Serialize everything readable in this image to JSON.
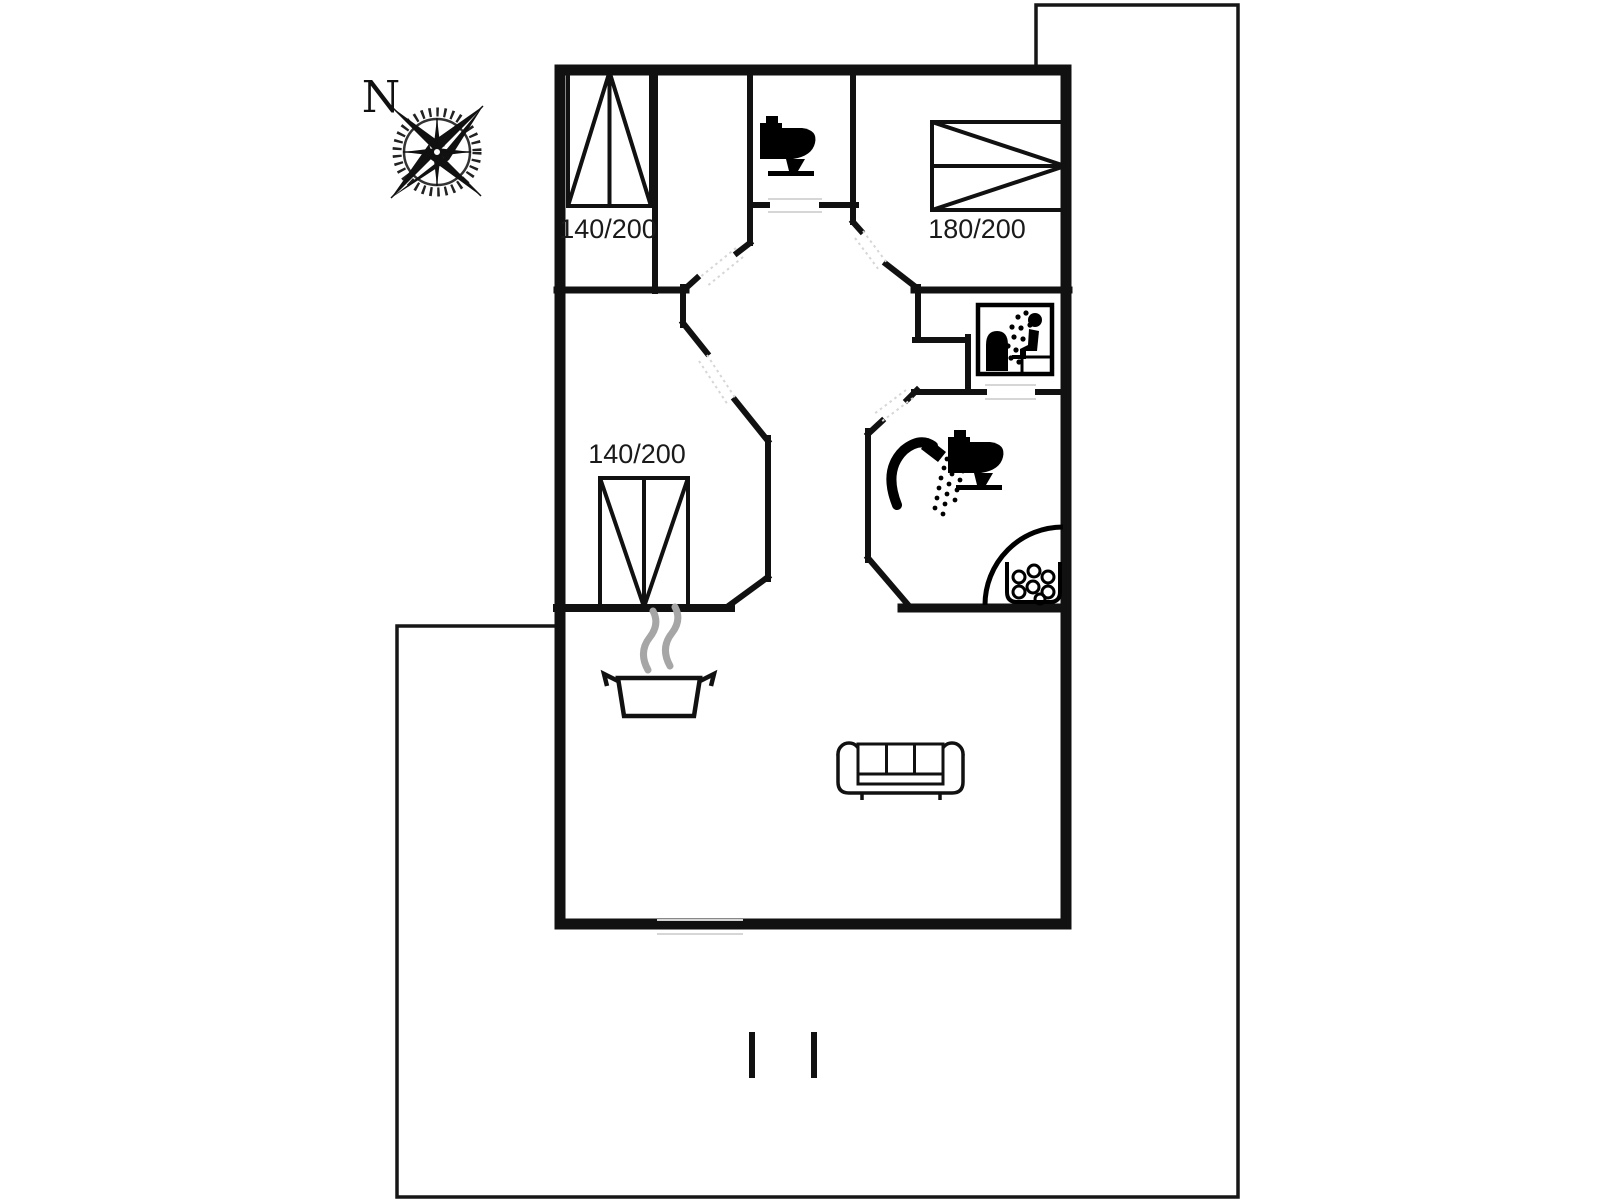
{
  "plan": {
    "compass_label": "N",
    "beds": {
      "bedroom_top_left_label": "140/200",
      "bedroom_middle_left_label": "140/200",
      "bedroom_top_right_label": "180/200"
    },
    "icons": [
      "compass-rose-icon",
      "toilet-icon",
      "toilet-icon",
      "shower-icon",
      "sauna-icon",
      "hot-tub-icon",
      "stove-pot-icon",
      "sofa-icon",
      "bed-icon",
      "bed-icon",
      "bed-icon"
    ],
    "colors": {
      "wall": "#111111",
      "steam": "#a6a6a6",
      "faint_door": "#d6d6d6",
      "background": "#ffffff"
    }
  }
}
